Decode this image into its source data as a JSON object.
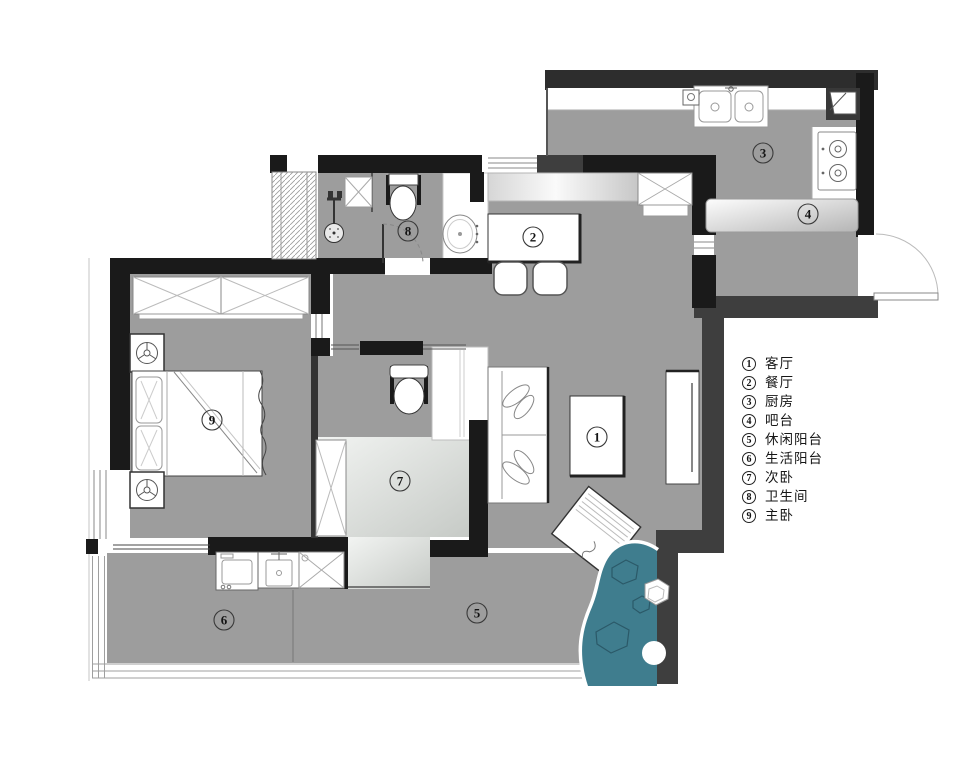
{
  "legend": {
    "items": [
      {
        "num": "1",
        "label": "客厅"
      },
      {
        "num": "2",
        "label": "餐厅"
      },
      {
        "num": "3",
        "label": "厨房"
      },
      {
        "num": "4",
        "label": "吧台"
      },
      {
        "num": "5",
        "label": "休闲阳台"
      },
      {
        "num": "6",
        "label": "生活阳台"
      },
      {
        "num": "7",
        "label": "次卧"
      },
      {
        "num": "8",
        "label": "卫生间"
      },
      {
        "num": "9",
        "label": "主卧"
      }
    ]
  },
  "plan": {
    "markers": [
      "1",
      "2",
      "3",
      "4",
      "5",
      "6",
      "7",
      "8",
      "9"
    ],
    "colors": {
      "floor": "#9d9d9d",
      "floor_light_1": "#f0f2f0",
      "floor_light_2": "#c8ccc8",
      "wall_black": "#1a1a1a",
      "wall_dark": "#3e3e3e",
      "water": "#3f7d8e",
      "fixture": "#ffffff"
    }
  }
}
